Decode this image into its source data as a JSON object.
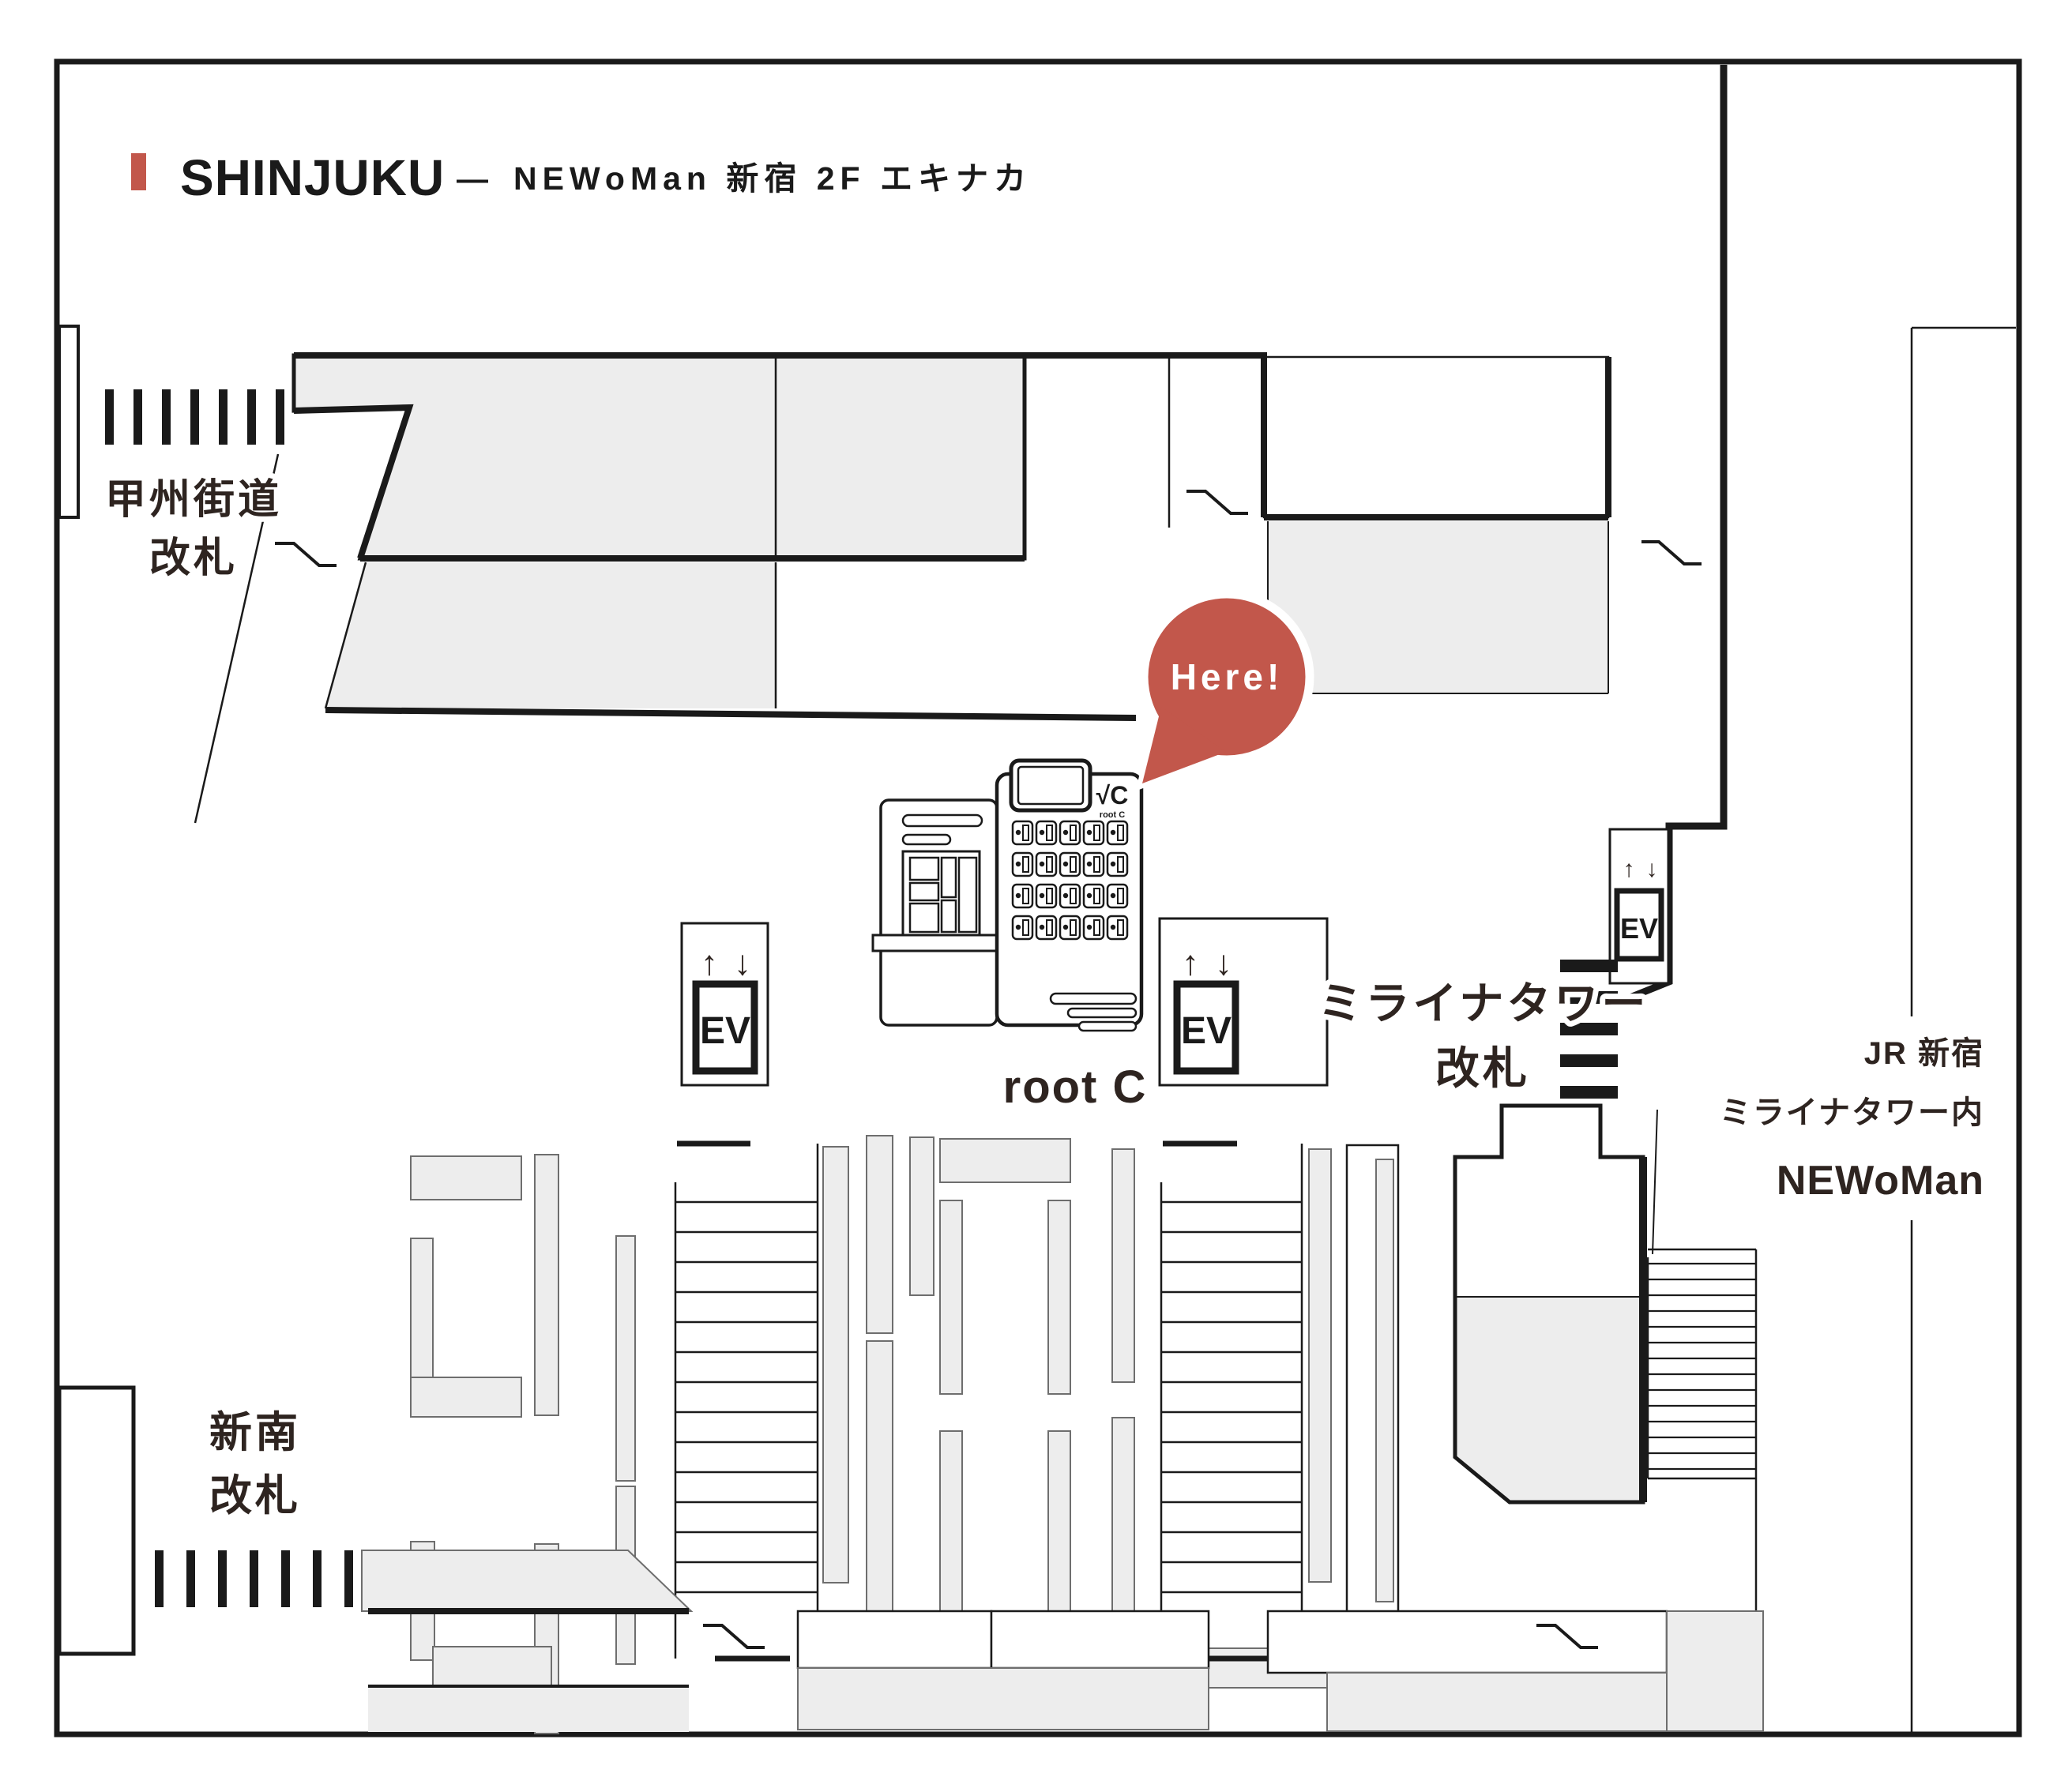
{
  "title": {
    "main": "SHINJUKU",
    "separator": "—",
    "subtitle": "NEWoMan 新宿 2F エキナカ",
    "accent_color": "#c2574b"
  },
  "gates": {
    "koshu_kaido": {
      "line1": "甲州街道",
      "line2": "改札"
    },
    "shin_minami": {
      "line1": "新南",
      "line2": "改札"
    },
    "miraina_tower": {
      "line1": "ミライナタワー",
      "line2": "改札"
    }
  },
  "area_labels": {
    "jr_shinjuku": "JR 新宿",
    "miraina_tower_inside": "ミライナタワー内",
    "newoman": "NEWoMan"
  },
  "store": {
    "name": "root C",
    "marker": "Here!",
    "logo": "√C",
    "logo_caption": "root C"
  },
  "elevator": {
    "label": "EV",
    "up": "↑",
    "down": "↓"
  },
  "colors": {
    "wall": "#1a1a1a",
    "area_fill": "#ededed",
    "marker_red": "#c2574b",
    "text_dark": "#2e2420",
    "background": "#ffffff"
  }
}
